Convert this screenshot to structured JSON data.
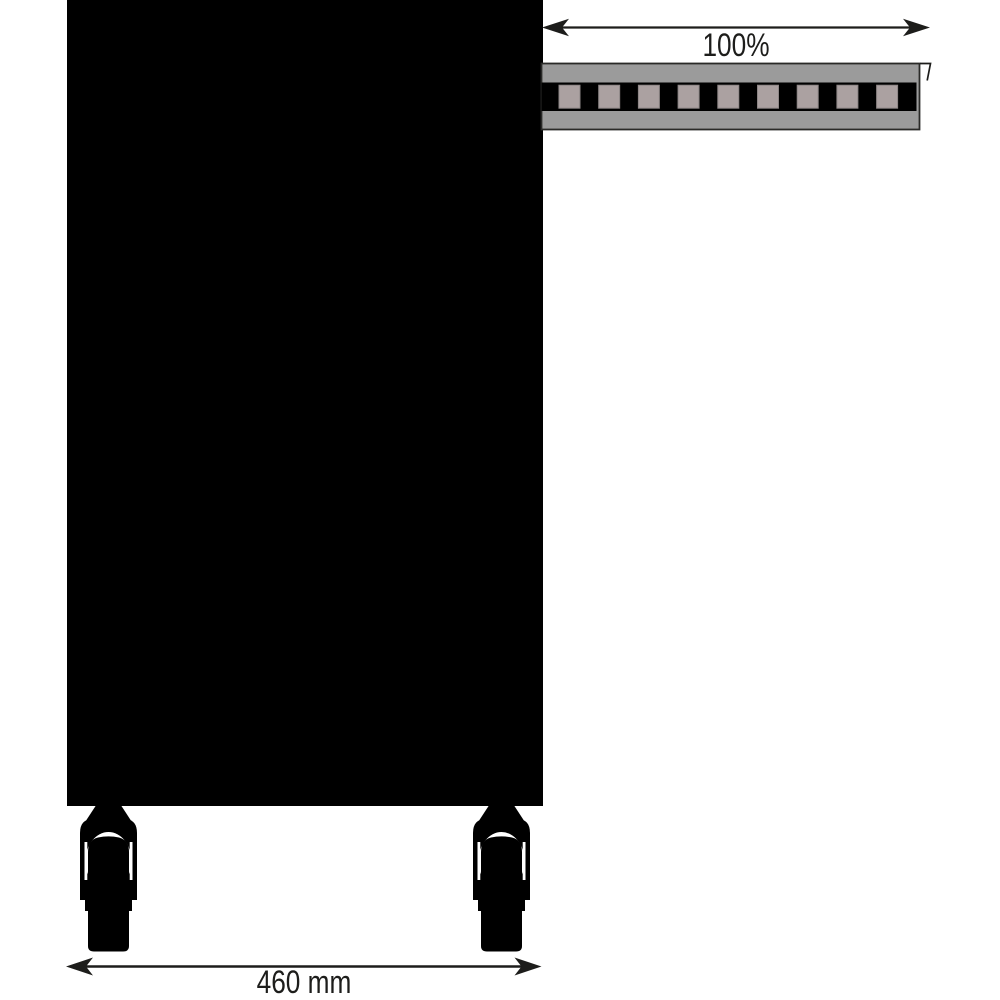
{
  "diagram": {
    "type": "technical-drawing",
    "subject": "cabinet side view with fully extended telescopic slide rail and casters",
    "labels": {
      "extension": "100%",
      "depth": "460 mm"
    },
    "rail": {
      "segments": 9
    },
    "colors": {
      "background": "#ffffff",
      "black": "#000000",
      "line": "#1d1d1b",
      "rail_gray": "#9b9b9b",
      "rail_outline": "#2a2a28",
      "slot_gray": "#aba1a1",
      "slot_outline": "#8d8686",
      "white": "#ffffff"
    }
  }
}
